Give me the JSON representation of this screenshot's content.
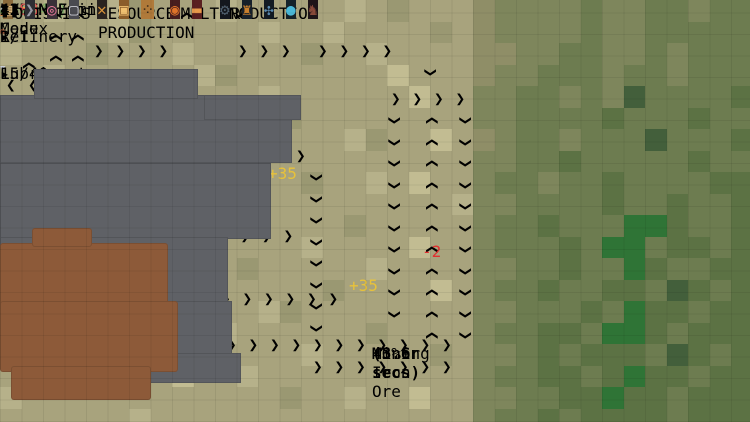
{
  "topbar": {
    "menu_label": "≡ Menu",
    "balance_label": "BALANCE",
    "balance_value": "126745",
    "income_label": "INCOME/min",
    "income_value": "4829",
    "income_extra": "(+2441)",
    "expense_label": "EXPENSE/min",
    "expense_value": "1388",
    "codex_label": "? Codex"
  },
  "colors": {
    "balance": "#e7b83a",
    "income": "#58b947",
    "income_dim": "#7fae6a",
    "expense": "#e05252",
    "progress": "#2f97e0",
    "accent_teal": "#3adbc8",
    "text_red": "#e03030",
    "text_gold": "#e8c23a"
  },
  "top_right_icons": [
    {
      "name": "pickaxe-icon",
      "glyph": "⚒",
      "color": "#b8b8b8"
    },
    {
      "name": "snowflake-icon",
      "glyph": "✳",
      "color": "#5aa8e8"
    },
    {
      "name": "flame-icon",
      "glyph": "▲",
      "color": "#e8742a"
    },
    {
      "name": "leaf-icon",
      "glyph": "✔",
      "color": "#58b947"
    }
  ],
  "panels": [
    {
      "title": "Refinery",
      "count": "1/1",
      "progress": 1.0,
      "icon_glyph": "◉",
      "icon_color": "#b05a3a",
      "top": 27,
      "height": 34,
      "more_label": "▸"
    },
    {
      "title": "Lubricant",
      "count": "15/40",
      "progress": 0.375,
      "icon_glyph": "💧",
      "icon_fallback": "▼",
      "icon_color": "#c8ccd4",
      "top": 64,
      "height": 36,
      "more_label": "▸"
    }
  ],
  "toolbar_groups": [
    {
      "label": "LOGISTICS",
      "x": 3,
      "buttons": [
        {
          "name": "crate-button",
          "glyph": "▤",
          "bg": "#8a6a3c",
          "border": "#c9a05a",
          "fg": "#e0c088"
        },
        {
          "name": "belt-button",
          "glyph": "❯",
          "bg": "#2e2e33",
          "border": "#6a6a72",
          "fg": "#9a9aa4"
        },
        {
          "name": "splitter-button",
          "glyph": "◎",
          "bg": "#3a3038",
          "border": "#8a6a78",
          "fg": "#e87a9a"
        },
        {
          "name": "storage-button",
          "glyph": "▢",
          "bg": "#4a4a50",
          "border": "#8a8a92",
          "fg": "#c8c8d0"
        }
      ]
    },
    {
      "label": "RESOURCE PRODUCTION",
      "x": 97,
      "buttons": [
        {
          "name": "miner-button",
          "glyph": "✕",
          "bg": "#2a2420",
          "border": "#e08a1c",
          "fg": "#d8933a"
        },
        {
          "name": "pump-button",
          "glyph": "▣",
          "bg": "#8a5c2a",
          "border": "#e0a048",
          "fg": "#f0c070"
        },
        {
          "name": "well-button",
          "glyph": "⁘",
          "bg": "#b07a3a",
          "border": "#e0a048",
          "fg": "#3a2a18"
        }
      ]
    },
    {
      "label": "SMELTING",
      "x": 170,
      "buttons": [
        {
          "name": "furnace-button",
          "glyph": "◉",
          "bg": "#481e1e",
          "border": "#a83232",
          "fg": "#e0742a"
        },
        {
          "name": "steel-furnace-button",
          "glyph": "▬",
          "bg": "#5a2020",
          "border": "#b04232",
          "fg": "#e89a4a"
        }
      ]
    },
    {
      "label": "PRODUCTION",
      "x": 220,
      "buttons": [
        {
          "name": "assembler-button",
          "glyph": "⚙",
          "bg": "#14181e",
          "border": "#3a5a72",
          "fg": "#50606e"
        },
        {
          "name": "factory-button",
          "glyph": "♜",
          "bg": "#16202a",
          "border": "#3a6a8a",
          "fg": "#c9802e"
        },
        {
          "name": "lab-button",
          "glyph": "✣",
          "bg": "#121a22",
          "border": "#3a5a72",
          "fg": "#5a8ab0"
        },
        {
          "name": "sphere-button",
          "glyph": "●",
          "bg": "#14222a",
          "border": "#3a7a9a",
          "fg": "#4ab8d8"
        },
        {
          "name": "armory-button",
          "glyph": "♞",
          "bg": "#1e1418",
          "border": "#6a3a42",
          "fg": "#8a4a3a"
        }
      ]
    }
  ],
  "speed_controls": {
    "buttons": [
      {
        "name": "speed-x1-button",
        "label": "x1",
        "active": true
      },
      {
        "name": "speed-x2-button",
        "label": "x2",
        "active": false
      },
      {
        "name": "speed-x3-button",
        "label": "x3",
        "active": false
      },
      {
        "name": "pause-button",
        "label": "❚❚",
        "active": false
      },
      {
        "name": "select-tool-button",
        "label": "➤",
        "active": false
      }
    ],
    "counter": "4",
    "trailing_button": {
      "name": "select-tool-button-2",
      "label": "➤"
    }
  },
  "tooltip": {
    "x": 372,
    "y": 344,
    "title": "Miner",
    "line2a": "Mining Iron Ore ",
    "line2b": "(3.6 secs)",
    "line3": "46%"
  },
  "map": {
    "tile": 21.5,
    "palette": {
      "a": "#b6b18a",
      "b": "#a8a37d",
      "c": "#9a9872",
      "d": "#c2bc92",
      "e": "#8f8e67",
      "f": "#7e865c",
      "g": "#6d7c50",
      "h": "#5c7244",
      "F": "#435f3b",
      "G": "#2f7436"
    },
    "terrain": [
      "bbabbacbbbabbbbbabcbbbeffffgffggfgg",
      "bbbbbacbbbbbabbabbbbcbeffffgffggggg",
      "abbbcbbbabbbbbcbbabbbbeeffggffgfggg",
      "bbabbbbbbacbbbbbbbdbbbeffgggfggfggg",
      "bbbbabcbbbbbabbbbbbdbbffggfgfFggggh",
      "bdbbbbbbbabbbcbbbbbbbbffgggghggghgg",
      "bbbbbabbbbbbabbbacbbdbefggfgggFgggh",
      "abbbbbbcbbbabbbbbbbbbbffgghggggghgg",
      "bbbabbbbbbbbbbcbbabdbbfggfgghgggghh",
      "bbbbbbabbcbbbbbbbbbbbaffgggghgghggh",
      "bbabbbbbbbbabbbbcbbbbbfgghgggGGhggh",
      "bbbbbabbbbbbbbabbbbdbbfggghgGGghhgh",
      "abbbbbbbabbcbbbbbabbbbffgghggGhgghh",
      "bbbbabbbbbbbbbbcbbbbdbfgghgghhgFhgh",
      "bbbbbbbabbbbacbbbbbbbbffggghgGhhghh",
      "bdbbbbbbbbabbbbbbcbbbbfgghhgGGhghhh",
      "bbbbbadbbbbbbbabbbbbcbffghghhhgFhgh",
      "bbbbbbbbdbbabbbbbbbbbbfgghhghGhhghh",
      "abbbbbbbbbbbbcbbabbdbbffgghhGhhghhh",
      "bbbbbbabbbbbbbbbbbbbbbfgghghhhhghhh"
    ],
    "stone_rects": [
      [
        0,
        4.4,
        13.6,
        3.2
      ],
      [
        0,
        7.6,
        12.6,
        3.5
      ],
      [
        0,
        11,
        10.6,
        3.2
      ],
      [
        1.8,
        14,
        9,
        2.6
      ],
      [
        4.6,
        16.4,
        6.6,
        1.4
      ],
      [
        1.6,
        3.2,
        7.6,
        1.4
      ],
      [
        9.5,
        4.4,
        4.5,
        1.2
      ]
    ],
    "copper_rects": [
      [
        0,
        11.3,
        7.8,
        3
      ],
      [
        0,
        14,
        8.3,
        3.3
      ],
      [
        0.5,
        17,
        6.5,
        1.6
      ],
      [
        1.5,
        10.6,
        2.8,
        0.9
      ]
    ],
    "iron_ore_rects": [
      [
        0.1,
        4.9,
        13,
        2.9
      ],
      [
        2.1,
        8,
        10.4,
        2.9
      ],
      [
        4.1,
        11,
        6.4,
        2.9
      ],
      [
        5.1,
        14,
        5.4,
        2
      ]
    ],
    "copper_ore_rects": [
      [
        0.2,
        11.5,
        7.2,
        2.6
      ],
      [
        0.2,
        14.2,
        7.7,
        2.8
      ],
      [
        0.8,
        17.1,
        5.9,
        1.3
      ]
    ],
    "belts": [
      {
        "d": "h",
        "x": 0,
        "y": 72,
        "len": 45,
        "a": "<",
        "items": null
      },
      {
        "d": "h",
        "x": 88,
        "y": 36,
        "len": 100,
        "a": ">",
        "items": null
      },
      {
        "d": "h",
        "x": 232,
        "y": 36,
        "len": 80,
        "a": ">",
        "items": "iron"
      },
      {
        "d": "h",
        "x": 312,
        "y": 36,
        "len": 102,
        "a": ">",
        "items": "copper"
      },
      {
        "d": "h",
        "x": 385,
        "y": 84,
        "len": 93,
        "a": ">",
        "items": "copper"
      },
      {
        "d": "h",
        "x": 118,
        "y": 141,
        "len": 212,
        "a": ">",
        "items": null
      },
      {
        "d": "h",
        "x": 195,
        "y": 173,
        "len": 80,
        "a": "<",
        "items": null
      },
      {
        "d": "h",
        "x": 127,
        "y": 221,
        "len": 190,
        "a": ">",
        "items": null
      },
      {
        "d": "h",
        "x": 172,
        "y": 284,
        "len": 185,
        "a": ">",
        "items": null
      },
      {
        "d": "h",
        "x": 135,
        "y": 330,
        "len": 330,
        "a": ">",
        "items": "copper"
      },
      {
        "d": "h",
        "x": 307,
        "y": 352,
        "len": 170,
        "a": ">",
        "items": "copper"
      },
      {
        "d": "v",
        "x": 45,
        "y": 0,
        "len": 80,
        "a": "^",
        "items": "iron"
      },
      {
        "d": "v",
        "x": 67,
        "y": 0,
        "len": 80,
        "a": "^",
        "items": "iron"
      },
      {
        "d": "v",
        "x": 18,
        "y": 50,
        "len": 24,
        "a": "^",
        "items": null
      },
      {
        "d": "v",
        "x": 176,
        "y": 0,
        "len": 38,
        "a": "^",
        "items": null
      },
      {
        "d": "v",
        "x": 232,
        "y": 0,
        "len": 38,
        "a": "^",
        "items": "iron"
      },
      {
        "d": "v",
        "x": 421,
        "y": 57,
        "len": 28,
        "a": "v",
        "items": "copper"
      },
      {
        "d": "v",
        "x": 385,
        "y": 105,
        "len": 226,
        "a": "v",
        "items": "copper"
      },
      {
        "d": "v",
        "x": 421,
        "y": 105,
        "len": 248,
        "a": "^",
        "items": null
      },
      {
        "d": "v",
        "x": 456,
        "y": 105,
        "len": 248,
        "a": "v",
        "items": "copper"
      },
      {
        "d": "v",
        "x": 307,
        "y": 162,
        "len": 192,
        "a": "v",
        "items": "pale"
      },
      {
        "d": "v",
        "x": 211,
        "y": 173,
        "len": 50,
        "a": "v",
        "items": null
      },
      {
        "d": "v",
        "x": 249,
        "y": 190,
        "len": 33,
        "a": "^",
        "items": null
      }
    ],
    "machines": [
      {
        "t": "miner",
        "x": 12,
        "y": 97
      },
      {
        "t": "miner",
        "x": 45,
        "y": 79
      },
      {
        "t": "miner",
        "x": 67,
        "y": 79
      },
      {
        "t": "miner",
        "x": 89,
        "y": 79
      },
      {
        "t": "miner",
        "x": 40,
        "y": 221
      },
      {
        "t": "miner",
        "x": 127,
        "y": 221
      },
      {
        "t": "miner",
        "x": 172,
        "y": 284
      },
      {
        "t": "miner",
        "x": 138,
        "y": 329
      },
      {
        "t": "miner_sel",
        "x": 117,
        "y": 140
      },
      {
        "t": "furnace",
        "x": 123,
        "y": 36
      },
      {
        "t": "furnace",
        "x": 155,
        "y": 140
      },
      {
        "t": "furnace_glow",
        "x": 231,
        "y": 141
      },
      {
        "t": "furnace",
        "x": 295,
        "y": 141
      },
      {
        "t": "furnace",
        "x": 155,
        "y": 221
      },
      {
        "t": "furnace",
        "x": 199,
        "y": 284
      },
      {
        "t": "furnace",
        "x": 384,
        "y": 282
      },
      {
        "t": "furnace_glow",
        "x": 419,
        "y": 282
      },
      {
        "t": "furnace",
        "x": 454,
        "y": 282
      },
      {
        "t": "dark",
        "x": 232,
        "y": 109
      },
      {
        "t": "dark",
        "x": 264,
        "y": 139
      },
      {
        "t": "storeO",
        "x": 294,
        "y": 109
      },
      {
        "t": "storeO",
        "x": 329,
        "y": 141
      },
      {
        "t": "storeP",
        "x": 420,
        "y": 83
      },
      {
        "t": "storeP",
        "x": 294,
        "y": 284
      },
      {
        "t": "blue",
        "x": 310,
        "y": 36
      },
      {
        "t": "blue",
        "x": 185,
        "y": 221
      },
      {
        "t": "blue",
        "x": 217,
        "y": 221
      },
      {
        "t": "blue",
        "x": 295,
        "y": 217
      },
      {
        "t": "blue",
        "x": 231,
        "y": 284
      },
      {
        "t": "blue",
        "x": 263,
        "y": 284
      },
      {
        "t": "bluecrown",
        "x": 384,
        "y": 221
      },
      {
        "t": "bluecrown",
        "x": 419,
        "y": 221
      },
      {
        "t": "bluecrown",
        "x": 454,
        "y": 221
      },
      {
        "t": "blue2",
        "x": 384,
        "y": 251
      },
      {
        "t": "blue2",
        "x": 419,
        "y": 251
      },
      {
        "t": "blue2",
        "x": 454,
        "y": 251
      },
      {
        "t": "crate",
        "x": 263,
        "y": 173
      },
      {
        "t": "crate",
        "x": 344,
        "y": 280
      },
      {
        "t": "splitter",
        "x": 425,
        "y": 40
      }
    ],
    "floating_texts": [
      {
        "x": 57,
        "y": 66,
        "t": "-1",
        "c": "red"
      },
      {
        "x": 229,
        "y": 95,
        "t": "-1",
        "c": "red"
      },
      {
        "x": 152,
        "y": 130,
        "t": "-3",
        "c": "red"
      },
      {
        "x": 264,
        "y": 134,
        "t": "-1",
        "c": "red"
      },
      {
        "x": 422,
        "y": 242,
        "t": "-2",
        "c": "red"
      },
      {
        "x": 268,
        "y": 164,
        "t": "+35",
        "c": "gold"
      },
      {
        "x": 349,
        "y": 276,
        "t": "+35",
        "c": "gold"
      }
    ],
    "chips": [
      {
        "x": 141,
        "y": 136
      },
      {
        "x": 286,
        "y": 150
      },
      {
        "x": 251,
        "y": 242
      },
      {
        "x": 452,
        "y": 239
      }
    ],
    "animals": [
      {
        "x": 630,
        "y": 391
      },
      {
        "x": 648,
        "y": 388
      },
      {
        "x": 666,
        "y": 386
      },
      {
        "x": 641,
        "y": 397
      }
    ],
    "cursor": {
      "x": 126,
      "y": 146
    }
  }
}
